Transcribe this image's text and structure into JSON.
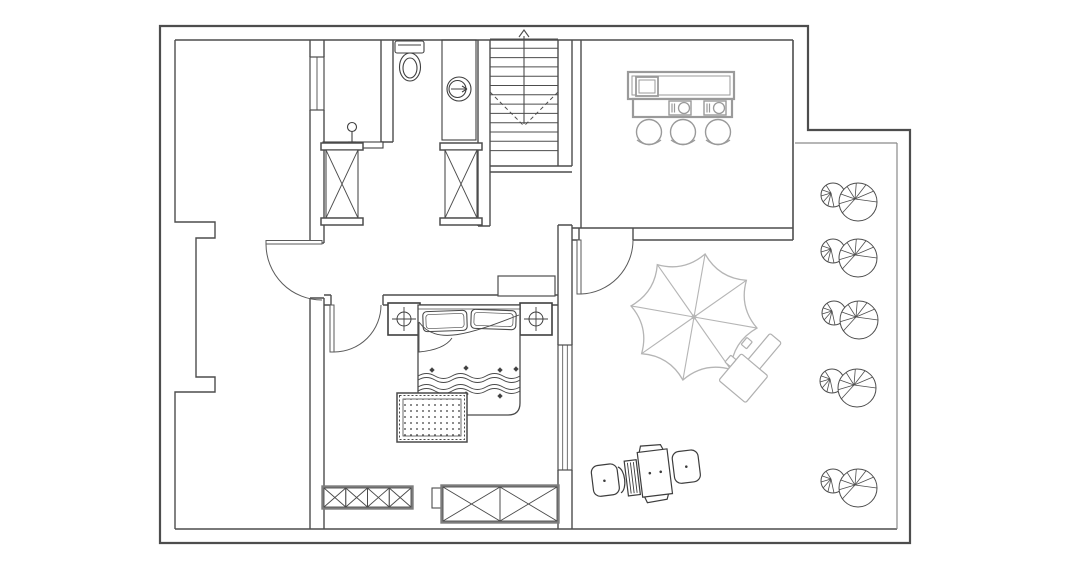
{
  "canvas": {
    "width": 1074,
    "height": 576,
    "background": "#ffffff"
  },
  "palette": {
    "wall": "#4d4d4d",
    "wall_inner": "#6a6a6a",
    "terrace_edge": "#8a8a8a",
    "fixture": "#3f3f3f",
    "furniture": "#4a4a4a",
    "cabinet_frame": "#7d7d7d",
    "counter": "#9a9a9a",
    "umbrella": "#b5b5b5",
    "tree": "#4d4d4d",
    "rug_dot": "#3a3a3a"
  },
  "elements": {
    "stairs": {
      "x": 490,
      "y": 26,
      "width": 68,
      "bottom": 166,
      "tread_start": 39,
      "tread_step": 9.3,
      "tread_count": 13
    },
    "bar": {
      "stool_centers": [
        [
          649,
          132
        ],
        [
          683,
          132
        ],
        [
          718,
          132
        ]
      ],
      "stool_radius": 12.5,
      "burner_centers": [
        [
          682,
          108
        ],
        [
          717,
          108
        ]
      ]
    },
    "trees": {
      "positions": [
        [
          858,
          202
        ],
        [
          858,
          258
        ],
        [
          859,
          320
        ],
        [
          857,
          388
        ],
        [
          858,
          488
        ]
      ],
      "big_radius": 19,
      "small_radius": 12,
      "small_offset": [
        -25,
        -7
      ],
      "big_spokes": [
        0,
        145,
        175,
        205,
        235,
        265,
        295,
        325
      ],
      "small_spokes": [
        85,
        115,
        145,
        175,
        205,
        235
      ]
    },
    "umbrella": {
      "cx": 694,
      "cy": 317,
      "outer_radius": 64,
      "valley_radius": 46,
      "panels": 8,
      "start_angle": -80
    },
    "wardrobes": [
      {
        "x": 324,
        "y": 488,
        "width": 87,
        "height": 19,
        "cells": 4
      },
      {
        "x": 443,
        "y": 487,
        "width": 114,
        "height": 34,
        "cells": 2
      }
    ],
    "bed_waves": {
      "x": 418,
      "width": 102,
      "rows": [
        376,
        380,
        387,
        391
      ],
      "half_wave": 17,
      "amp": 5
    },
    "bed_dots": [
      [
        432,
        370
      ],
      [
        466,
        368
      ],
      [
        500,
        370
      ],
      [
        516,
        369
      ],
      [
        432,
        396
      ],
      [
        466,
        394
      ],
      [
        500,
        396
      ]
    ]
  },
  "inventory": {
    "rooms_without_labels": 5,
    "doors": 3,
    "windows": 2,
    "closet_columns": 2,
    "bar_stools": 3,
    "trees": 5,
    "beds": 1,
    "nightstands": 2,
    "wardrobe_units": 2,
    "parasols": 1,
    "recliners": 1
  }
}
